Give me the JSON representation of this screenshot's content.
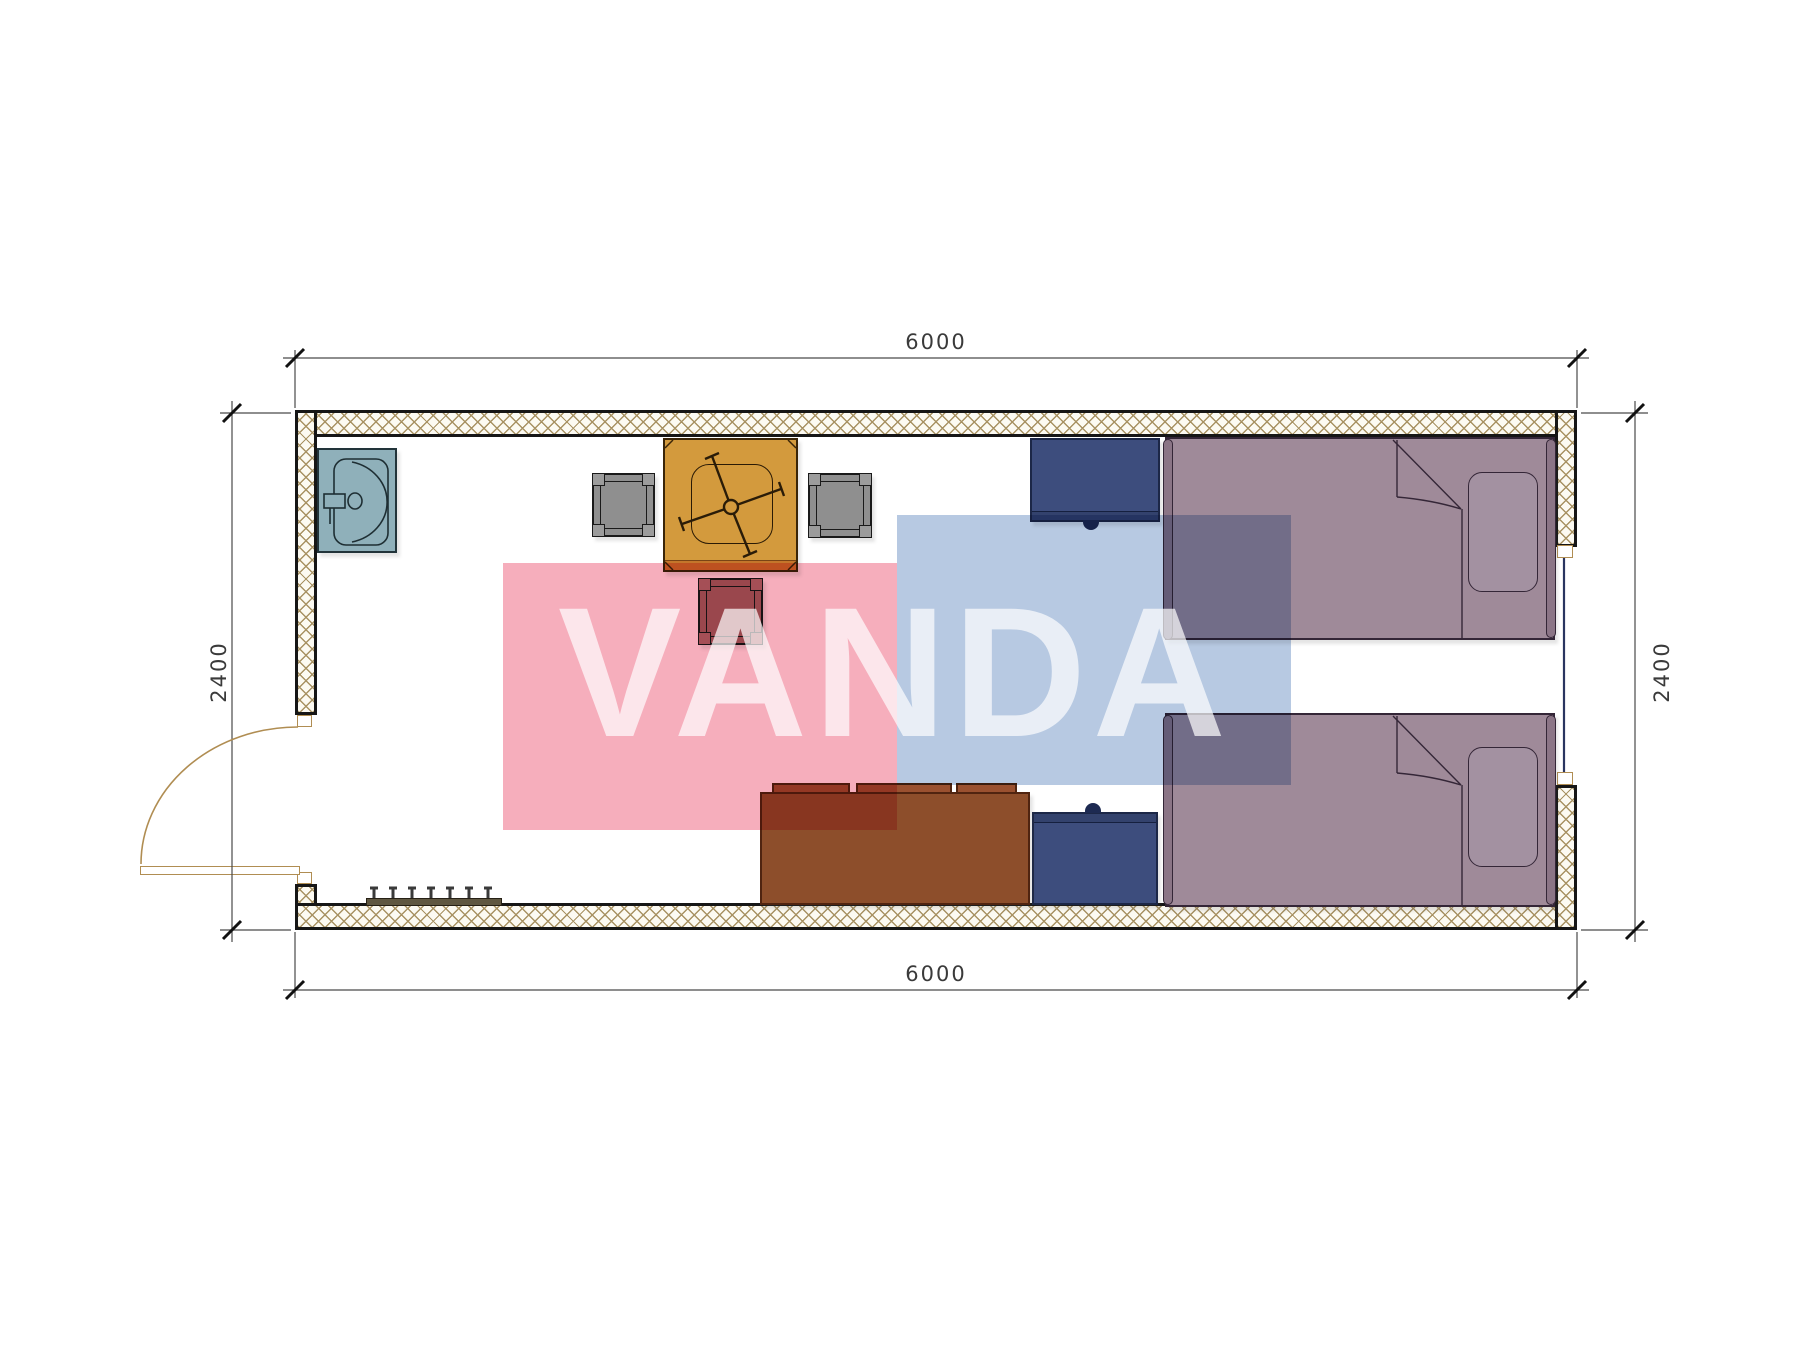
{
  "drawing_type": "container-room-floor-plan",
  "dimensions": {
    "top": "6000",
    "bottom": "6000",
    "left": "2400",
    "right": "2400"
  },
  "watermark": {
    "text": "VANDA",
    "pink_block": "#f6aebc",
    "blue_block": "#b7c9e2"
  },
  "furniture": [
    "sink",
    "dining-chair",
    "dining-chair",
    "rose-chair",
    "square-table",
    "swivel-office-chair",
    "nightstand",
    "nightstand",
    "sofa",
    "single-bed",
    "single-bed",
    "pillow",
    "pillow",
    "coat-rack",
    "swing-door",
    "window"
  ],
  "colors": {
    "wall_hatch": "#a89263",
    "wall_border": "#161616",
    "sink": "#8fb0ba",
    "chair_gray": "#8f8f8f",
    "chair_rose": "#a06868",
    "table_orange": "#d39a3d",
    "nightstand_blue": "#3d4d7d",
    "sofa_brown": "#8d4e2b",
    "bed_mauve": "#9f8a99",
    "door_arc": "#b08d52",
    "dimension_text": "#3a3a3a"
  }
}
